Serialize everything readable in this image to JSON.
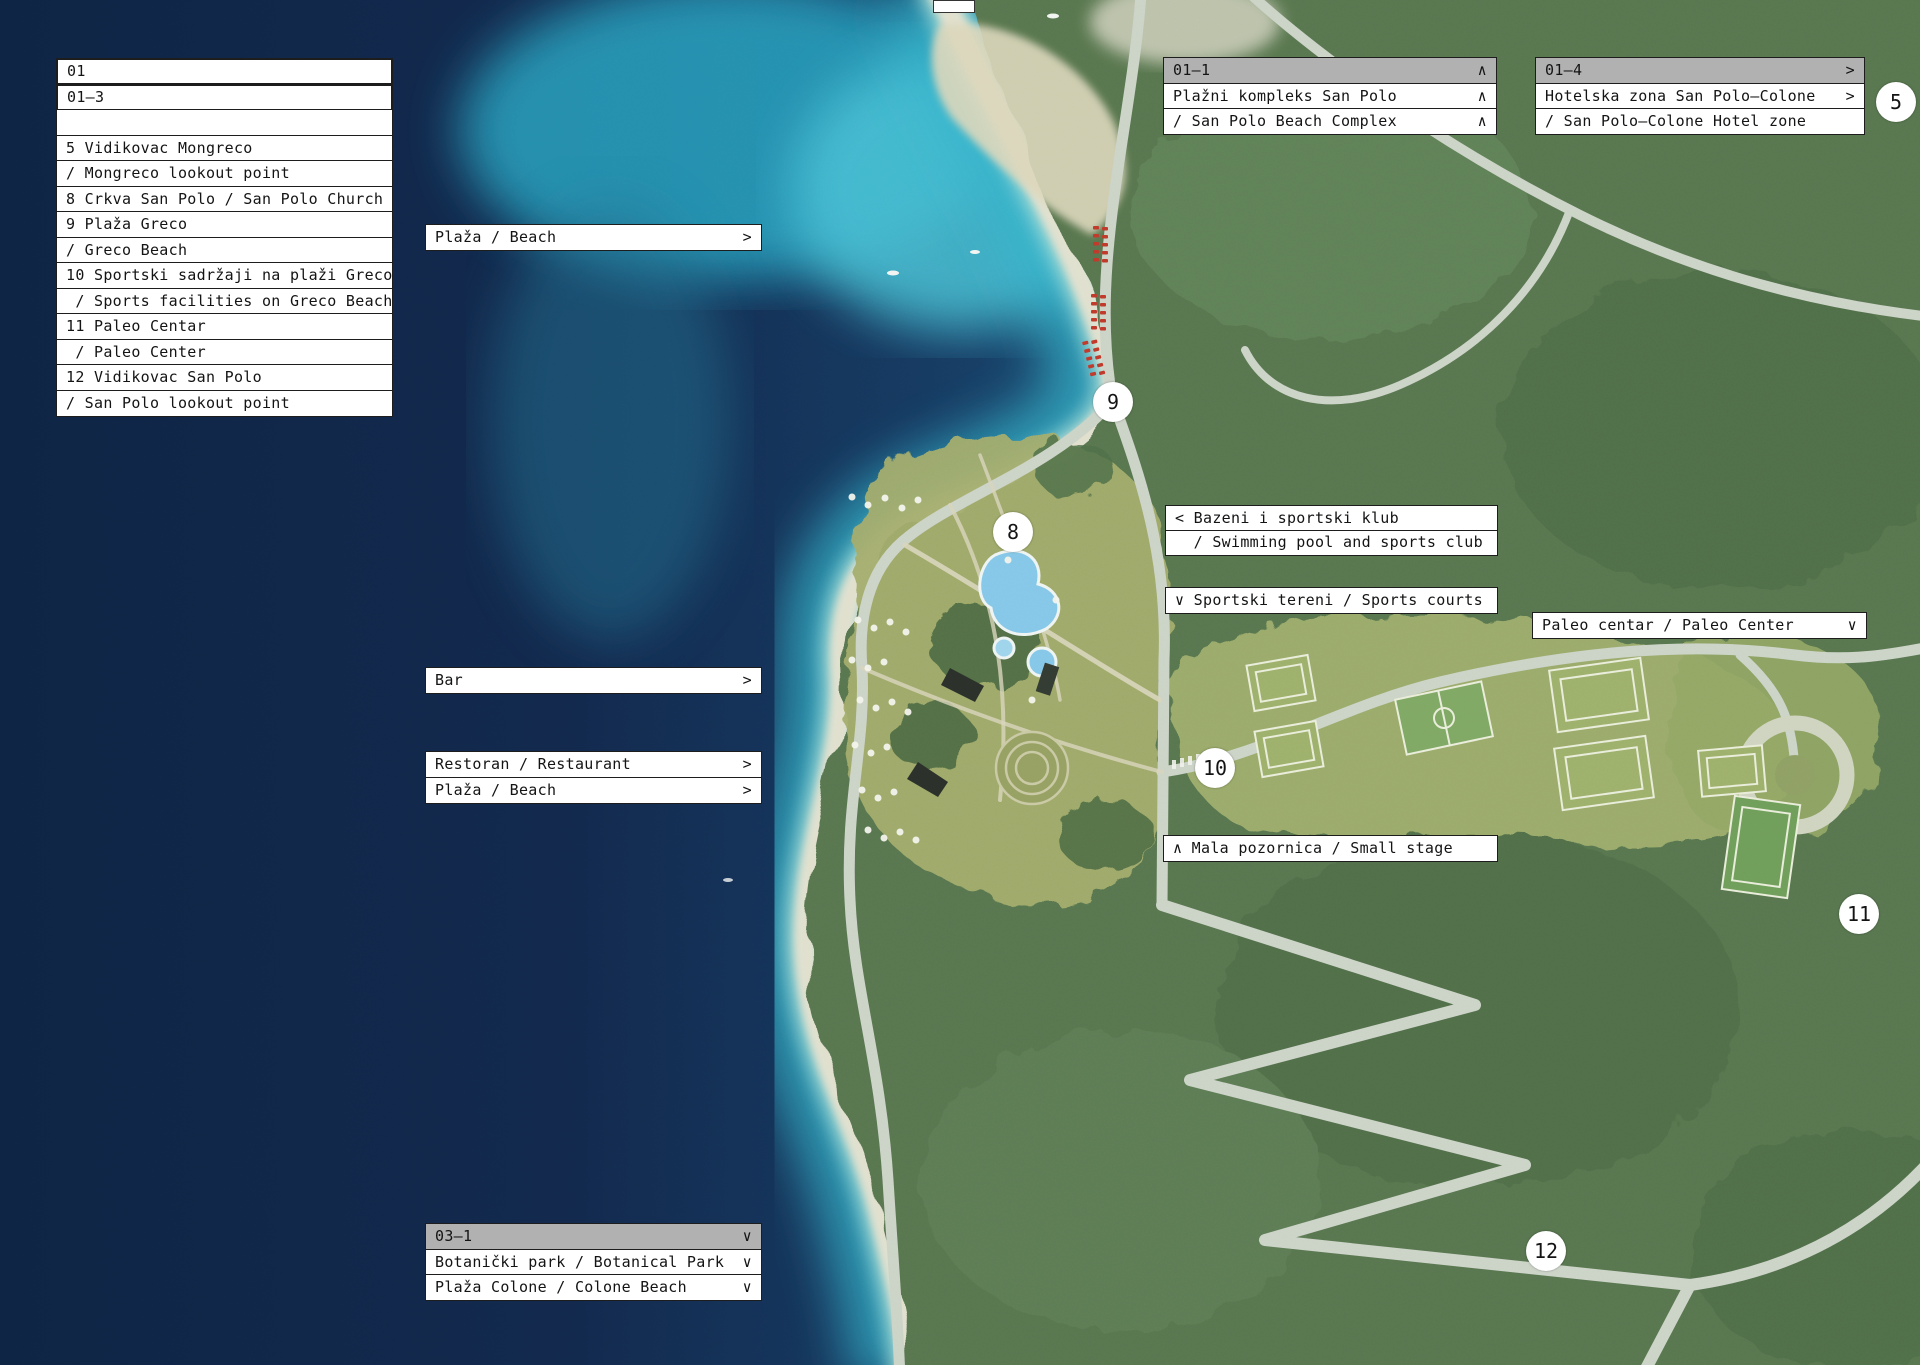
{
  "legend": {
    "rows": [
      {
        "text": "01"
      },
      {
        "text": "01–3"
      },
      {
        "text": ""
      },
      {
        "text": "5 Vidikovac Mongreco"
      },
      {
        "text": "/ Mongreco lookout point"
      },
      {
        "text": "8 Crkva San Polo / San Polo Church"
      },
      {
        "text": "9 Plaža Greco"
      },
      {
        "text": "/ Greco Beach"
      },
      {
        "text": "10 Sportski sadržaji na plaži Greco"
      },
      {
        "text": " / Sports facilities on Greco Beach"
      },
      {
        "text": "11 Paleo Centar"
      },
      {
        "text": " / Paleo Center"
      },
      {
        "text": "12 Vidikovac San Polo"
      },
      {
        "text": "/ San Polo lookout point"
      }
    ]
  },
  "boxes": {
    "plaza_top": {
      "text": "Plaža / Beach",
      "arrow": ">"
    },
    "bar": {
      "text": "Bar",
      "arrow": ">"
    },
    "restoran": {
      "text": "Restoran / Restaurant",
      "arrow": ">"
    },
    "plaza_mid": {
      "text": "Plaža / Beach",
      "arrow": ">"
    },
    "bazeni_row1": {
      "text": "< Bazeni i sportski klub"
    },
    "bazeni_row2": {
      "text": "  / Swimming pool and sports club"
    },
    "sportski_tereni": {
      "text": "∨ Sportski tereni / Sports courts"
    },
    "paleo": {
      "text": "Paleo centar / Paleo Center",
      "arrow": "∨"
    },
    "mala": {
      "text": "∧ Mala pozornica / Small stage"
    }
  },
  "panels": {
    "p011": {
      "code": "01–1",
      "code_arrow": "∧",
      "rows": [
        {
          "text": "Plažni kompleks San Polo",
          "arrow": "∧"
        },
        {
          "text": "/ San Polo Beach Complex",
          "arrow": "∧"
        }
      ]
    },
    "p014": {
      "code": "01–4",
      "code_arrow": ">",
      "rows": [
        {
          "text": "Hotelska zona San Polo–Colone",
          "arrow": ">"
        },
        {
          "text": "/ San Polo–Colone Hotel zone",
          "arrow": ""
        }
      ]
    },
    "p031": {
      "code": "03–1",
      "code_arrow": "∨",
      "rows": [
        {
          "text": "Botanički park / Botanical Park",
          "arrow": "∨"
        },
        {
          "text": "Plaža Colone / Colone Beach",
          "arrow": "∨"
        }
      ]
    }
  },
  "markers": [
    {
      "label": "5"
    },
    {
      "label": "8"
    },
    {
      "label": "9"
    },
    {
      "label": "10"
    },
    {
      "label": "11"
    },
    {
      "label": "12"
    }
  ],
  "colors": {
    "sea_deep": "#112a4d",
    "sea_turquoise": "#35b4cb",
    "shore_sand": "#e6e2cf",
    "forest_green": "#587650",
    "meadow_olive": "#a3ac6c",
    "road_gray": "#ccd3c7",
    "panel_header_gray": "#b1b1b1",
    "marker_bg": "#ffffff",
    "umbrella_red": "#c0392b"
  }
}
